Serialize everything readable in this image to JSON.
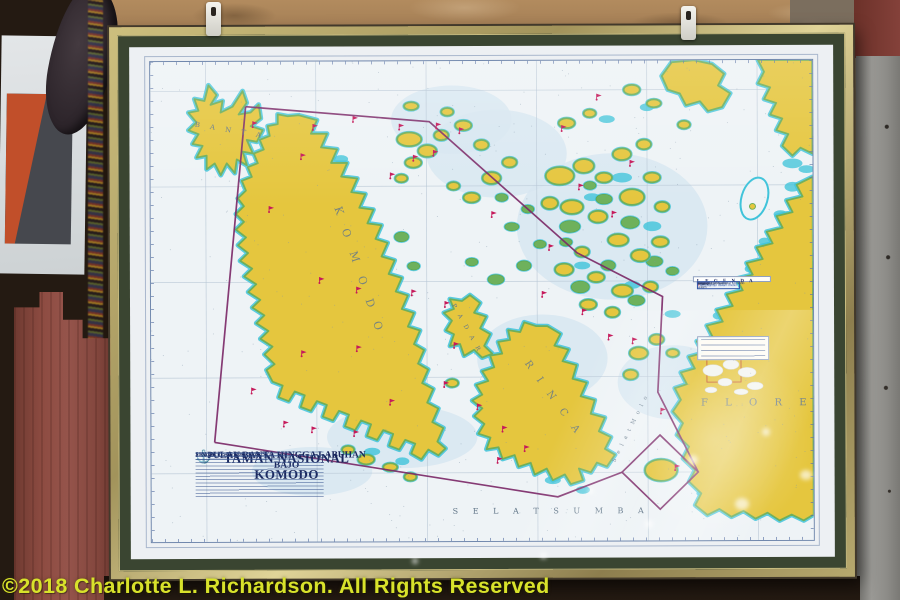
{
  "watermark": {
    "text": "©2018 Charlotte L. Richardson. All Rights Reserved",
    "color": "#d8e22b"
  },
  "chart": {
    "title_block": {
      "emblem_icon": "⚓",
      "country": "INDONESIA",
      "title": "TAMAN NASIONAL KOMODO",
      "subtitle": "PULAU BANTA HINGGA LABUHAN BAJO",
      "scale": "SKALA 1 : 75 000 (8°27'S)"
    },
    "island_labels": {
      "banta": "B A N T A",
      "komodo": "K O M O D O",
      "padar": "P A D A R",
      "rinca": "R I N C A",
      "flores": "F L O R E S"
    },
    "sea_labels": {
      "selat_sumba": "S E L A T    S U M B A",
      "selat_molo": "S e l a t   M o l o"
    },
    "legend": {
      "title": "L E G E N D A",
      "items": [
        {
          "g": "⚓",
          "c": "#1b2a5e",
          "t": "Jangkar"
        },
        {
          "g": "▪",
          "c": "#c5195a",
          "t": "Lokasi selam"
        },
        {
          "g": "✦",
          "c": "#1b2a5e",
          "t": "Suar"
        },
        {
          "g": "▴",
          "c": "#222222",
          "t": "Kerangka"
        },
        {
          "g": "▪",
          "c": "#6eb15c",
          "t": "Karang"
        },
        {
          "g": "◦",
          "c": "#1b2a5e",
          "t": "Bagan"
        }
      ],
      "rules": [
        {
          "c": "#7c2a68",
          "t": "Batas Taman Nasional Komodo"
        },
        {
          "c": "#5b73a5",
          "t": "Batas alur pelayaran"
        }
      ],
      "note": "Kedalaman dalam meter"
    },
    "colors": {
      "land": "#e5c63e",
      "reef_green": "#6eb15c",
      "shallow_cyan": "#3fc3da",
      "sea": "#eef3f6",
      "boundary_purple": "#7c2a68",
      "marker_magenta": "#c5195a",
      "grid_blue": "#b6c5d4",
      "label_blue": "#64788a",
      "navy": "#19265c"
    },
    "markers": [
      [
        102,
        67
      ],
      [
        150,
        100
      ],
      [
        162,
        70
      ],
      [
        202,
        62
      ],
      [
        248,
        70
      ],
      [
        285,
        69
      ],
      [
        308,
        74
      ],
      [
        282,
        97
      ],
      [
        262,
        102
      ],
      [
        239,
        120
      ],
      [
        118,
        154
      ],
      [
        168,
        227
      ],
      [
        205,
        237
      ],
      [
        260,
        240
      ],
      [
        293,
        252
      ],
      [
        205,
        297
      ],
      [
        150,
        302
      ],
      [
        100,
        340
      ],
      [
        132,
        374
      ],
      [
        160,
        380
      ],
      [
        202,
        384
      ],
      [
        238,
        352
      ],
      [
        302,
        294
      ],
      [
        292,
        334
      ],
      [
        325,
        357
      ],
      [
        350,
        380
      ],
      [
        372,
        400
      ],
      [
        345,
        412
      ],
      [
        390,
        242
      ],
      [
        427,
        132
      ],
      [
        397,
        194
      ],
      [
        460,
        160
      ],
      [
        478,
        108
      ],
      [
        508,
        362
      ],
      [
        522,
        420
      ],
      [
        410,
        72
      ],
      [
        445,
        40
      ],
      [
        480,
        290
      ],
      [
        340,
        160
      ],
      [
        430,
        260
      ],
      [
        456,
        286
      ]
    ]
  }
}
